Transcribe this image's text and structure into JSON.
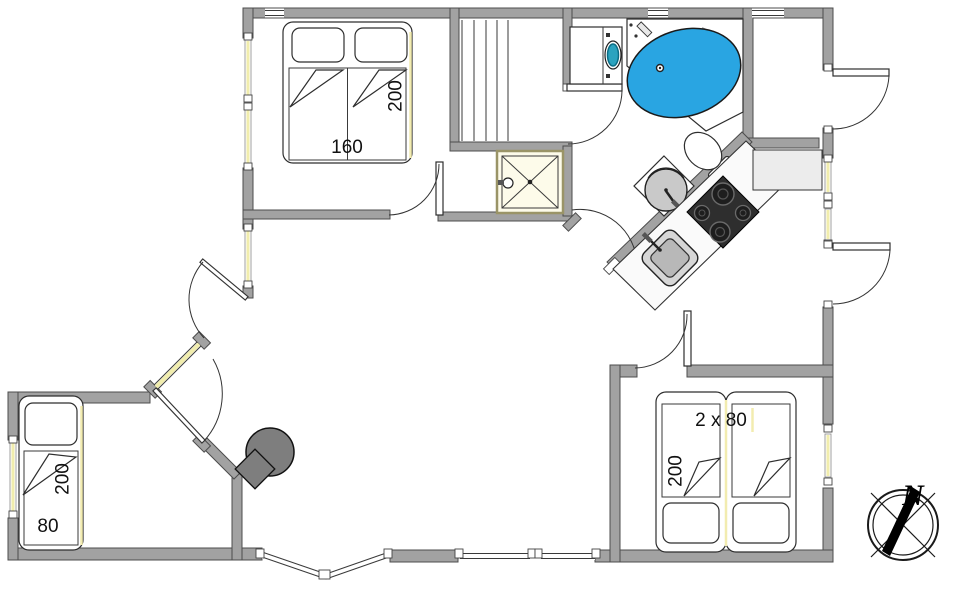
{
  "floor_plan": {
    "bedroom_top_left": {
      "bed_width": "160",
      "bed_length": "200"
    },
    "bedroom_bottom_left": {
      "bed_width": "80",
      "bed_length": "200"
    },
    "bedroom_bottom_right": {
      "bed_width": "2 x 80",
      "bed_length": "200"
    },
    "compass": {
      "north_label": "N"
    }
  },
  "colors": {
    "wall": "#a2a2a2",
    "wall_outline": "#4c4c4c",
    "window": "#f1edad",
    "bathtub_water": "#29a5e2",
    "washer_porthole": "#2ba3bf",
    "stove_body": "#7e7e7e",
    "cooktop": "#2e2e2e",
    "fixture_gray": "#c9c9c9",
    "cabinet": "#ececec",
    "bed_accent": "#f2ecb0"
  },
  "fixtures": [
    "double-bed",
    "single-bed",
    "twin-beds",
    "sauna-bench",
    "shower",
    "washing-machine",
    "corner-bathtub",
    "toilet",
    "washbasin",
    "cooktop",
    "kitchen-sink",
    "wood-stove",
    "compass-rose"
  ]
}
